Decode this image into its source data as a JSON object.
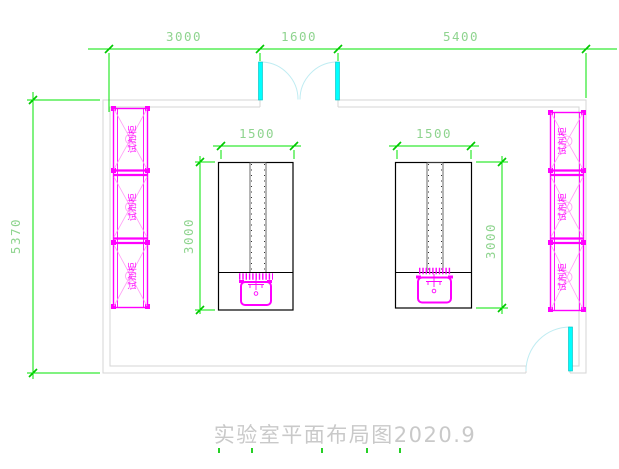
{
  "title": {
    "text": "实验室平面布局图2020.9"
  },
  "dimensions": {
    "top_segments": [
      "3000",
      "1600",
      "5400"
    ],
    "room_depth": "5370",
    "bench_left": {
      "width": "1500",
      "depth": "3000"
    },
    "bench_right": {
      "width": "1500",
      "depth": "3000"
    }
  },
  "cabinets": {
    "label": "试剂柜",
    "left_count": 3,
    "right_count": 3
  },
  "colors": {
    "dimension_lines": "#00e400",
    "dimension_text": "#8fd48f",
    "cabinet_magenta": "#ff00ff",
    "cabinet_diagonal": "#ffa0f5",
    "door_cyan": "#00ffff",
    "wall_gray": "#d5d5d5",
    "bench_black": "#000000",
    "title_gray": "#c9c9c9",
    "background": "#ffffff"
  }
}
